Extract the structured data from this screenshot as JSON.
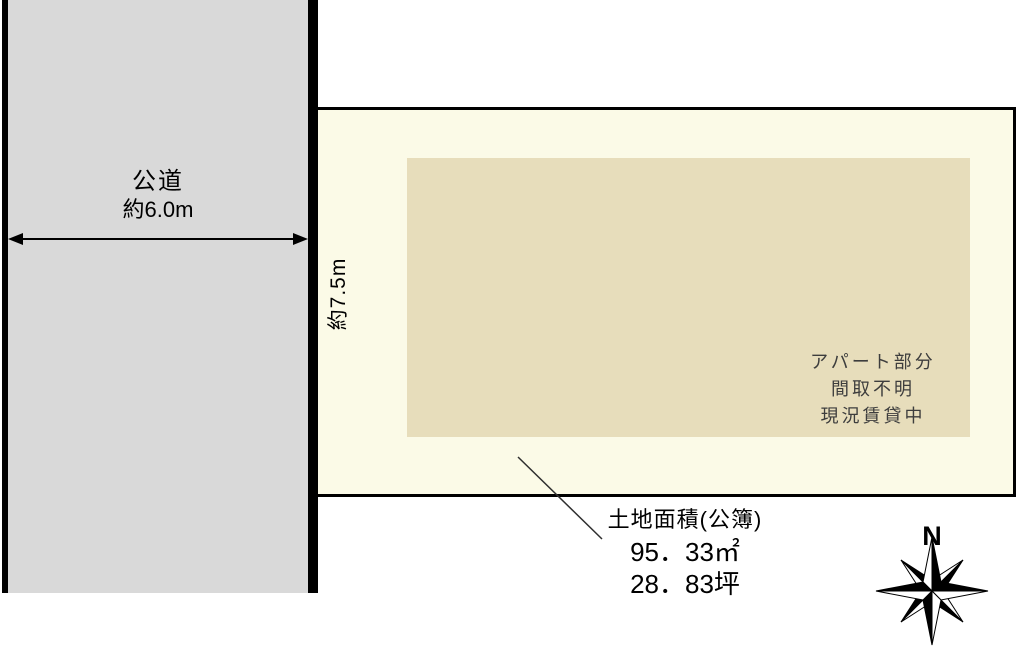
{
  "diagram_title": "land-plot-layout",
  "road": {
    "name": "公道",
    "width_label": "約6.0m"
  },
  "plot": {
    "frontage_label": "約7.5m"
  },
  "building": {
    "lines": [
      "アパート部分",
      "間取不明",
      "現況賃貸中"
    ]
  },
  "land_area": {
    "title": "土地面積(公簿)",
    "area_sqm": "95．33㎡",
    "area_tsubo": "28．83坪"
  },
  "compass": {
    "north_label": "N"
  },
  "colors": {
    "road_fill": "#D9D9D9",
    "plot_fill": "#FBFAE7",
    "building_fill": "#E7DDBB",
    "line": "#000000"
  }
}
